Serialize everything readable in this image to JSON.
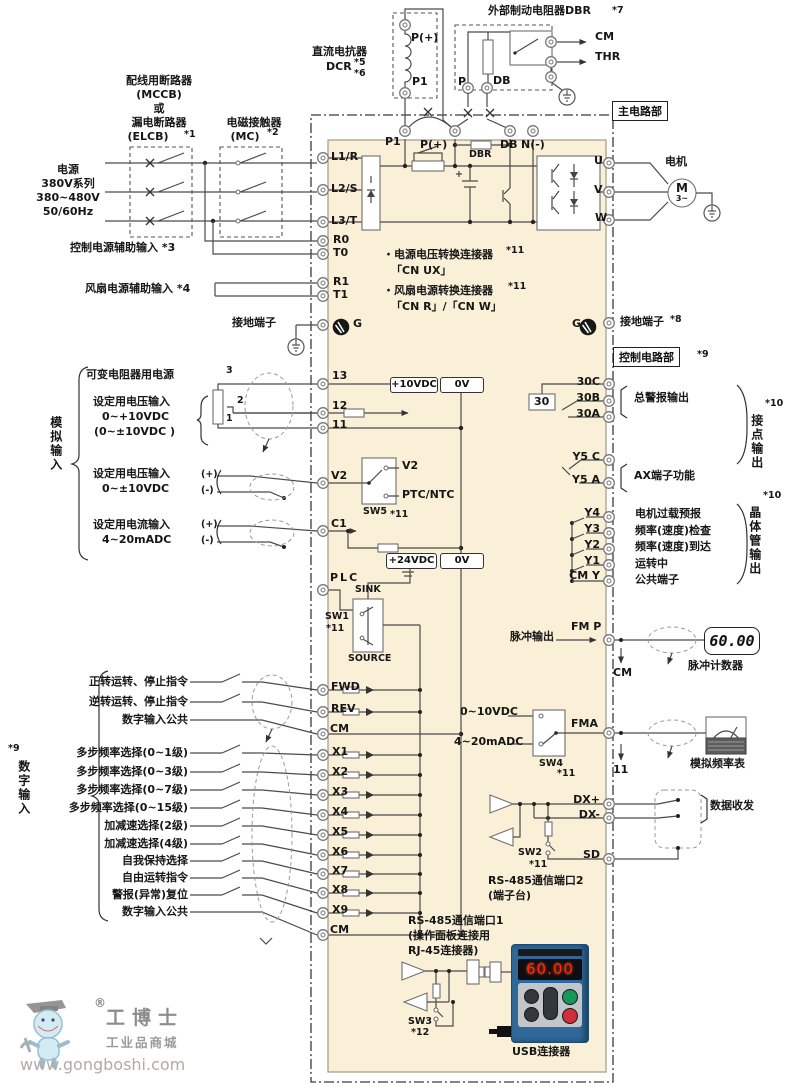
{
  "diagram": {
    "power": [
      "电源",
      "380V系列",
      "380~480V",
      "50/60Hz"
    ],
    "mccb": [
      "配线用断路器",
      "(MCCB)",
      "或",
      "漏电断路器",
      "(ELCB)"
    ],
    "mccb_note": "*1",
    "mc": [
      "电磁接触器",
      "(MC)"
    ],
    "mc_note": "*2",
    "aux_ctrl": "控制电源辅助输入 *3",
    "aux_fan": "风扇电源辅助输入 *4",
    "gnd_left": "接地端子",
    "gnd_right": "接地端子",
    "gnd_right_note": "*8",
    "dcr": {
      "title": "直流电抗器",
      "name": "DCR",
      "n1": "*5",
      "n2": "*6",
      "top": "P(+)",
      "bottom": "P1"
    },
    "dbr": {
      "title": "外部制动电阻器DBR",
      "note": "*7",
      "p": "P",
      "db": "DB",
      "cm": "CM",
      "thr": "THR"
    },
    "sections": {
      "main": "主电路部",
      "ctrl": "控制电路部",
      "ctrl_note": "*9"
    },
    "top_terms": {
      "p1": "P1",
      "pp": "P(+)",
      "dbr": "DBR",
      "db": "DB",
      "n": "N(-)"
    },
    "left_terms": [
      "L1/R",
      "L2/S",
      "L3/T",
      "R0",
      "T0",
      "R1",
      "T1",
      "G"
    ],
    "motor": {
      "label": "电机",
      "m": "M",
      "ph": "3~",
      "u": "U",
      "v": "V",
      "w": "W",
      "g": "G"
    },
    "conn": {
      "l1": "・电源电压转换连接器",
      "n1": "*11",
      "l2": "「CN UX」",
      "l3": "・风扇电源转换连接器",
      "n2": "*11",
      "l4": "「CN R」/「CN W」"
    },
    "analog": {
      "group": "模拟输入",
      "r1": "可变电阻器用电源",
      "r2": "设定用电压输入",
      "r2a": "0~+10VDC",
      "r2b": "(0~±10VDC )",
      "r3": "设定用电压输入",
      "r3a": "0~±10VDC",
      "r4": "设定用电流输入",
      "r4a": "4~20mADC",
      "plus": "(+)",
      "minus": "(-)",
      "pins": [
        "3",
        "2",
        "1"
      ],
      "t13": "13",
      "t12": "12",
      "t11": "11",
      "tv2": "V2",
      "tc1": "C1",
      "tplc": "PLC",
      "p10": "+10VDC",
      "p0a": "0V",
      "p24": "+24VDC",
      "p0b": "0V",
      "sw5": "SW5",
      "sw5n": "*11",
      "sw5v2": "V2",
      "sw5ptc": "PTC/NTC"
    },
    "sink": {
      "sink": "SINK",
      "source": "SOURCE",
      "sw1": "SW1",
      "n": "*11"
    },
    "digital": {
      "group": "数字输入",
      "note": "*9",
      "labels": [
        "正转运转、停止指令",
        "逆转运转、停止指令",
        "数字输入公共",
        "多步频率选择(0~1级)",
        "多步频率选择(0~3级)",
        "多步频率选择(0~7级)",
        "多步频率选择(0~15级)",
        "加减速选择(2级)",
        "加减速选择(4级)",
        "自我保持选择",
        "自由运转指令",
        "警报(异常)复位",
        "数字输入公共"
      ],
      "terms": [
        "FWD",
        "REV",
        "CM",
        "X1",
        "X2",
        "X3",
        "X4",
        "X5",
        "X6",
        "X7",
        "X8",
        "X9",
        "CM"
      ]
    },
    "outputs": {
      "t30c": "30C",
      "t30b": "30B",
      "t30a": "30A",
      "coil": "30",
      "y5c": "Y5 C",
      "y5a": "Y5 A",
      "y": [
        "Y4",
        "Y3",
        "Y2",
        "Y1",
        "CM Y"
      ],
      "alarm": "总警报输出",
      "ax": "AX端子功能",
      "fn": [
        "电机过载预报",
        "频率(速度)检查",
        "频率(速度)到达",
        "运转中",
        "公共端子"
      ],
      "contact": "接点输出",
      "contact_n": "*10",
      "transistor": "晶体管输出",
      "transistor_n": "*10"
    },
    "fm": {
      "label": "脉冲输出",
      "term": "FM P",
      "cm": "CM",
      "value": "60.00",
      "counter": "脉冲计数器"
    },
    "fma": {
      "in1": "0~10VDC",
      "in2": "4~20mADC",
      "sw4": "SW4",
      "n": "*11",
      "term": "FMA",
      "ret": "11",
      "meter": "模拟频率表"
    },
    "rs2": {
      "dxp": "DX+",
      "dxm": "DX-",
      "sd": "SD",
      "sw2": "SW2",
      "n": "*11",
      "t1": "RS-485通信端口2",
      "t2": "(端子台)",
      "data": "数据收发"
    },
    "rs1": {
      "t1": "RS-485通信端口1",
      "t2": "(操作面板连接用",
      "t3": "RJ-45连接器)",
      "sw3": "SW3",
      "n": "*12",
      "usb": "USB连接器",
      "value": "60.00"
    }
  },
  "logo": {
    "reg": "®",
    "name": "工博士",
    "sub": "工业品商城",
    "url": "www.gongboshi.com"
  },
  "colors": {
    "body": "#faf0d8",
    "wire": "#4a4a4a",
    "display_red": "#ff2d00",
    "keypad_blue": "#2f6899"
  }
}
